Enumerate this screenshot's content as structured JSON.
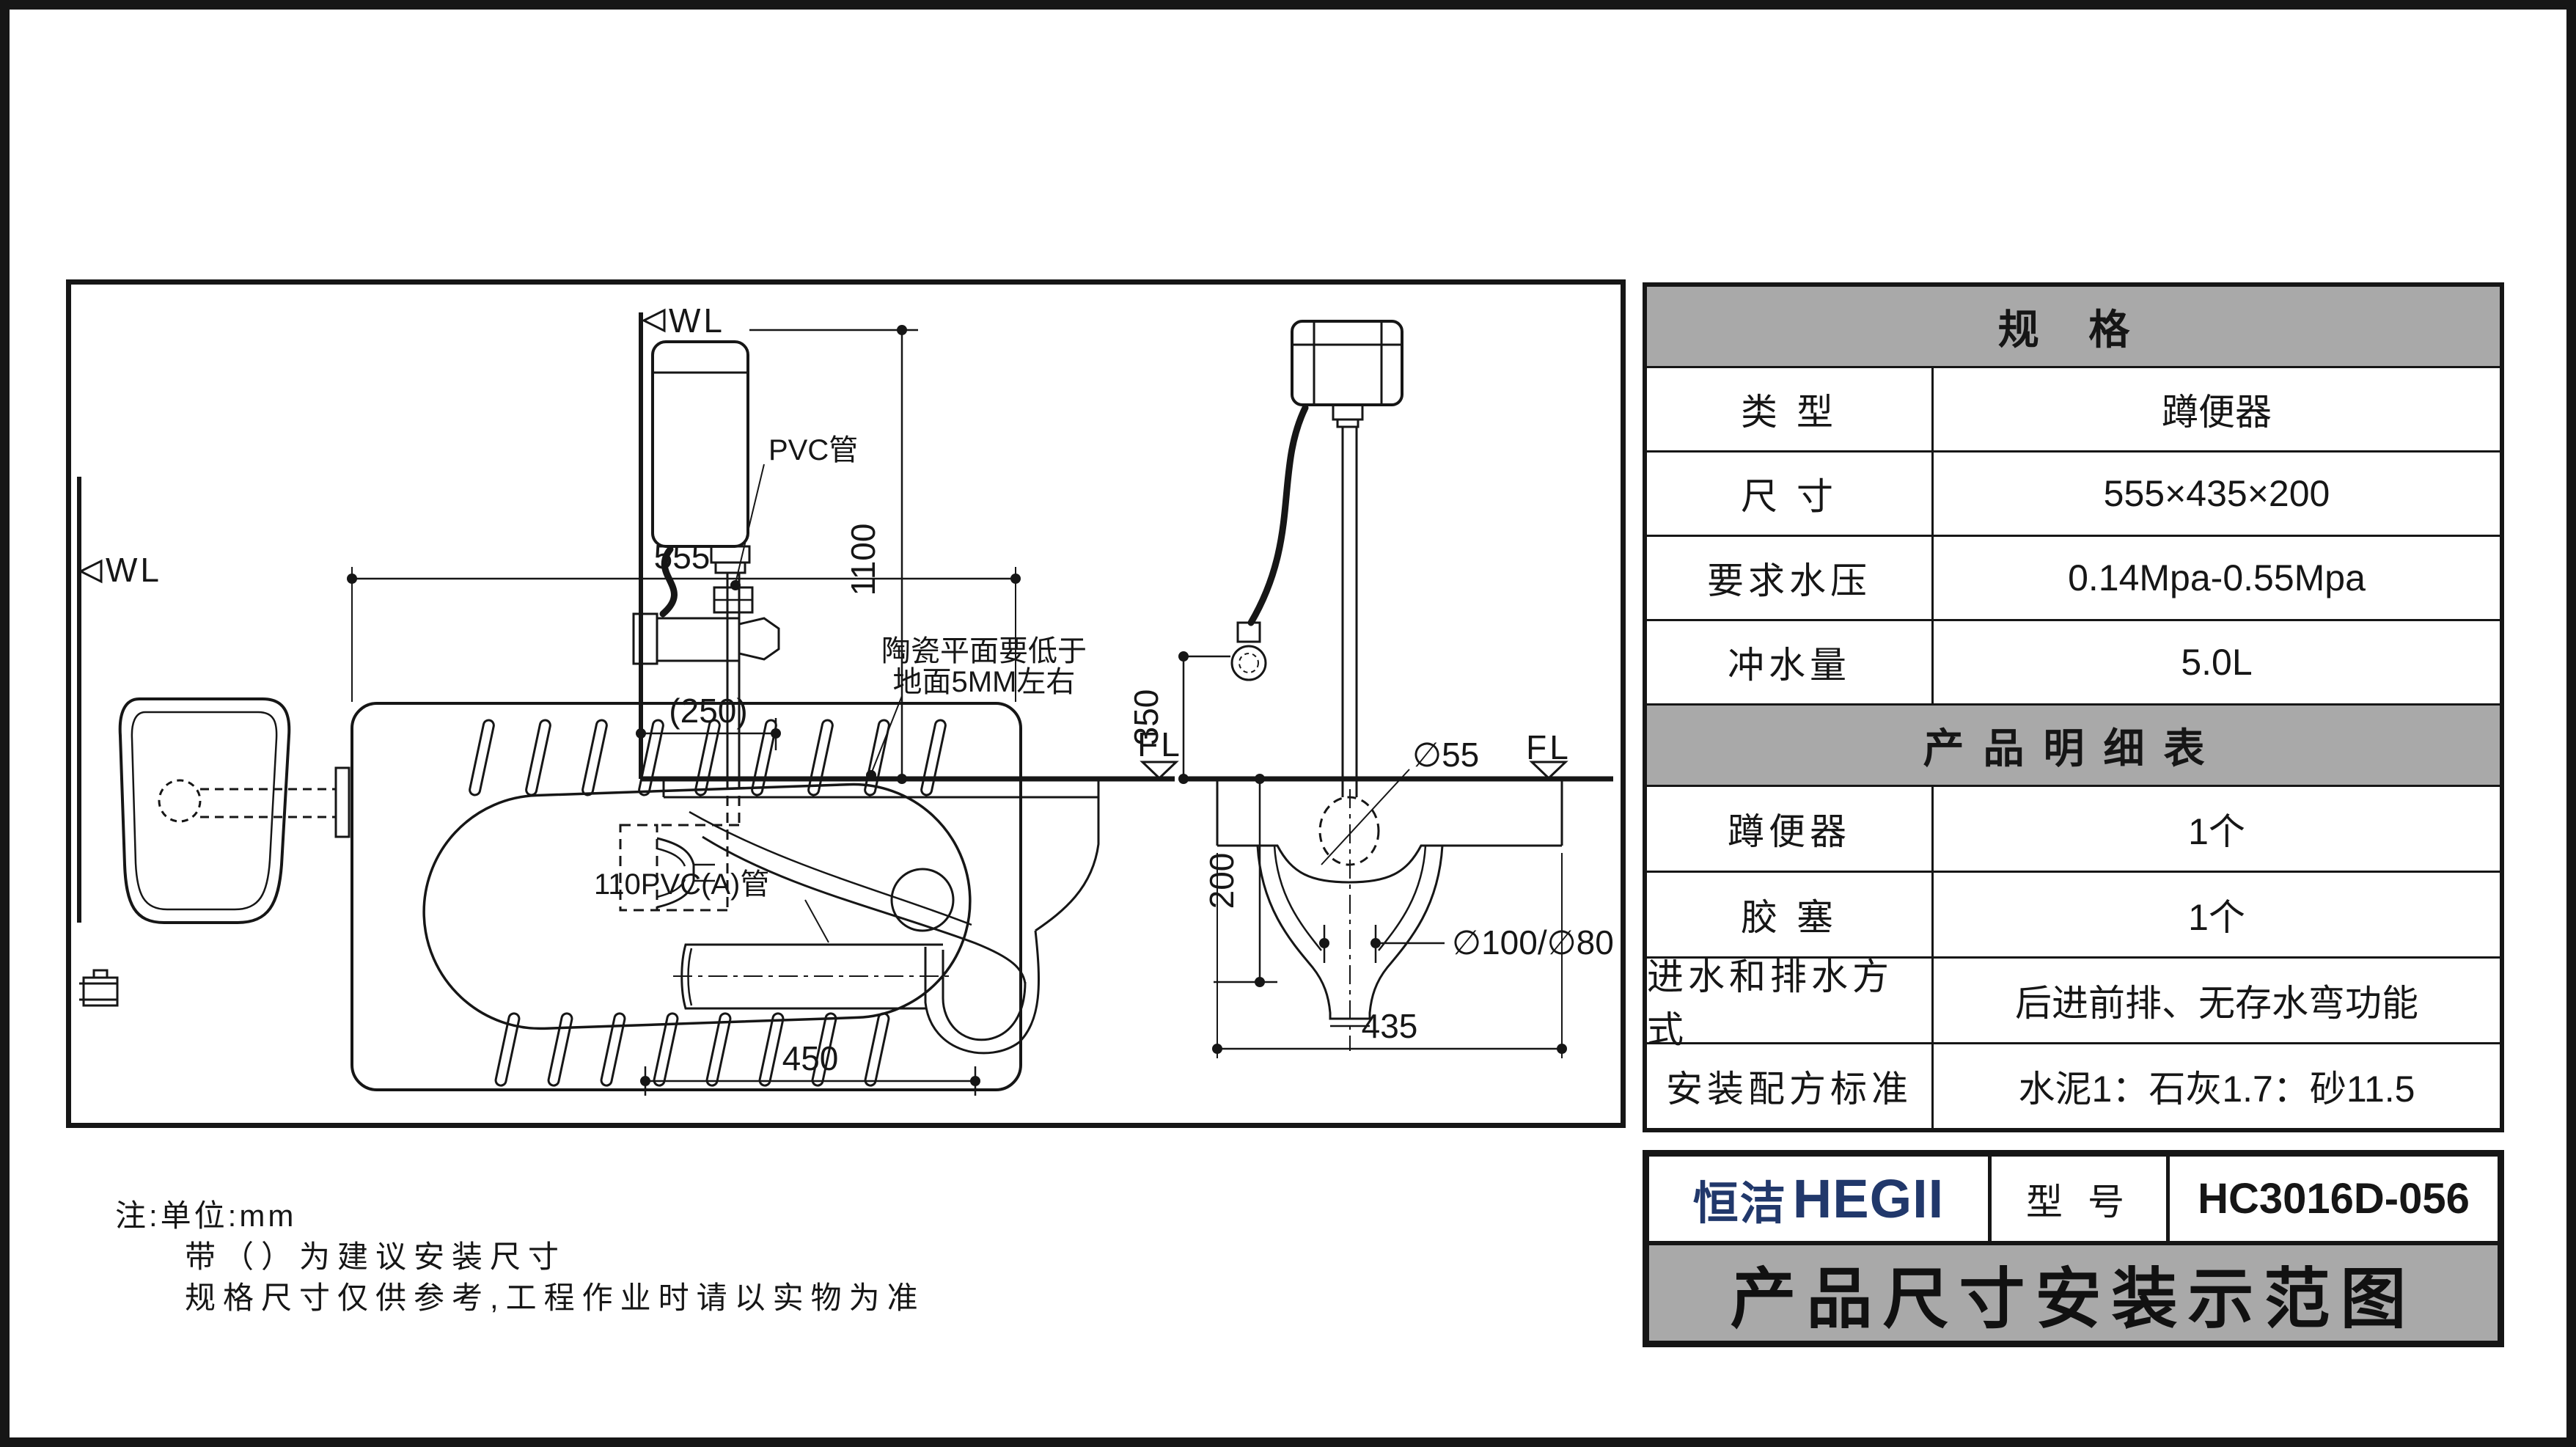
{
  "drawing": {
    "wall_marker": "WL",
    "floor_marker": "FL",
    "dims": {
      "pan_width": "555",
      "cistern_height": "1100",
      "pipe_offset": "(250)",
      "trap_length": "450",
      "pan_depth": "200",
      "hose_height": "350",
      "hole_dia": "∅55",
      "outlet_dia": "∅100/∅80",
      "pan_front_width": "435"
    },
    "labels": {
      "pvc_pipe": "PVC管",
      "pvc110_pipe": "110PVC(A)管",
      "ceramic_note_line1": "陶瓷平面要低于",
      "ceramic_note_line2": "地面5MM左右"
    }
  },
  "notes": {
    "line1": "注:单位:mm",
    "line2": "带（）为建议安装尺寸",
    "line3": "规格尺寸仅供参考,工程作业时请以实物为准"
  },
  "spec_table": {
    "header": "规  格",
    "rows": [
      {
        "label": "类  型",
        "value": "蹲便器"
      },
      {
        "label": "尺  寸",
        "value": "555×435×200"
      },
      {
        "label": "要求水压",
        "value": "0.14Mpa-0.55Mpa"
      },
      {
        "label": "冲水量",
        "value": "5.0L"
      }
    ],
    "detail_header": "产品明细表",
    "detail_rows": [
      {
        "label": "蹲便器",
        "value": "1个"
      },
      {
        "label": "胶  塞",
        "value": "1个"
      },
      {
        "label": "进水和排水方式",
        "value": "后进前排、无存水弯功能"
      },
      {
        "label": "安装配方标准",
        "value": "水泥1：石灰1.7：砂11.5"
      }
    ]
  },
  "title_block": {
    "brand_cn": "恒洁",
    "brand_en": "HEGII",
    "model_label": "型 号",
    "model_value": "HC3016D-056",
    "sheet_title": "产品尺寸安装示范图"
  },
  "colors": {
    "header_gray": "#a9a9a9",
    "logo_navy": "#21386b",
    "line_black": "#161616"
  }
}
